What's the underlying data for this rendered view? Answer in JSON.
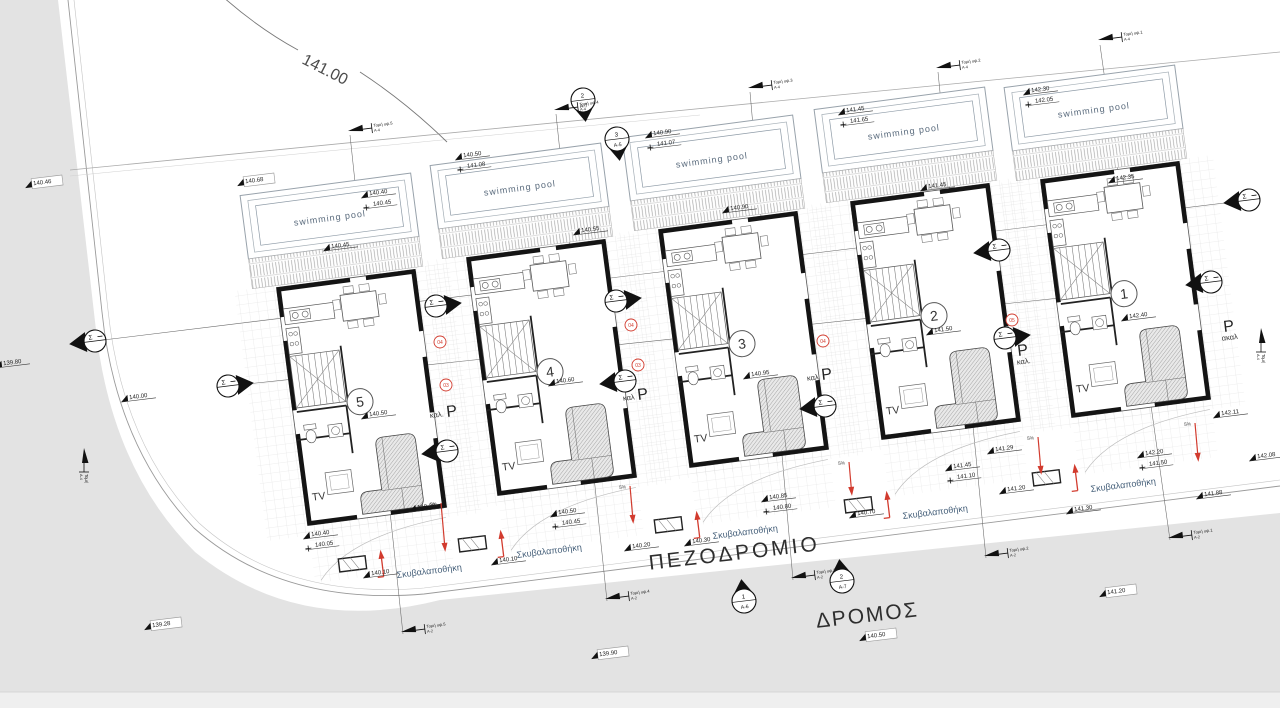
{
  "labels": {
    "contour": "141.00",
    "road": "ΔΡΟΜΟΣ",
    "sidewalk": "ΠΕΖΟΔΡΟΜΙΟ",
    "pool": "swimming pool",
    "tv": "TV",
    "garbage": "Σκυβαλαποθήκη",
    "parking_letter": "P",
    "sigma": "Σ",
    "percent": "5%"
  },
  "colors": {
    "road_gray": "#e3e3e3",
    "road_gray_light": "#efefef",
    "wall": "#141414",
    "line": "#3a3a3a",
    "light_line": "#c8c8c8",
    "red": "#d23b2e",
    "blue_text": "#46607a",
    "pool_text": "#5a6b7d"
  },
  "units": [
    {
      "number": "5",
      "x": 252,
      "y": 194,
      "rot": -7.5
    },
    {
      "number": "4",
      "x": 442,
      "y": 164,
      "rot": -7.5
    },
    {
      "number": "3",
      "x": 634,
      "y": 136,
      "rot": -7.5
    },
    {
      "number": "2",
      "x": 826,
      "y": 108,
      "rot": -7.5
    },
    {
      "number": "1",
      "x": 1016,
      "y": 86,
      "rot": -7.5
    }
  ],
  "spot_elevations": [
    {
      "v": "140.46",
      "x": 34,
      "y": 186,
      "box": true
    },
    {
      "v": "140.68",
      "x": 246,
      "y": 184,
      "box": true
    },
    {
      "v": "139.80",
      "x": 4,
      "y": 366
    },
    {
      "v": "140.00",
      "x": 130,
      "y": 400
    },
    {
      "v": "139.28",
      "x": 153,
      "y": 628,
      "box": true
    },
    {
      "v": "139.90",
      "x": 600,
      "y": 657,
      "box": true
    },
    {
      "v": "140.50",
      "x": 868,
      "y": 639,
      "box": true
    },
    {
      "v": "141.20",
      "x": 1108,
      "y": 595,
      "box": true
    },
    {
      "v": "140.10",
      "x": 372,
      "y": 576
    },
    {
      "v": "140.20",
      "x": 418,
      "y": 510
    },
    {
      "v": "140.10",
      "x": 500,
      "y": 563
    },
    {
      "v": "140.20",
      "x": 633,
      "y": 549
    },
    {
      "v": "140.30",
      "x": 693,
      "y": 544
    },
    {
      "v": "140.70",
      "x": 858,
      "y": 516
    },
    {
      "v": "141.20",
      "x": 1008,
      "y": 492
    },
    {
      "v": "141.29",
      "x": 996,
      "y": 452
    },
    {
      "v": "141.30",
      "x": 1075,
      "y": 512
    },
    {
      "v": "141.88",
      "x": 1205,
      "y": 497
    },
    {
      "v": "142.08",
      "x": 1258,
      "y": 459
    },
    {
      "v": "142.11",
      "x": 1222,
      "y": 416
    },
    {
      "v": "140.45",
      "x": 332,
      "y": 249
    },
    {
      "v": "140.55",
      "x": 582,
      "y": 233
    },
    {
      "v": "140.90",
      "x": 731,
      "y": 211
    },
    {
      "v": "141.45",
      "x": 929,
      "y": 189
    },
    {
      "v": "142.35",
      "x": 1117,
      "y": 181
    },
    {
      "v": "140.50",
      "x": 370,
      "y": 417
    },
    {
      "v": "140.60",
      "x": 557,
      "y": 384
    },
    {
      "v": "140.95",
      "x": 752,
      "y": 377
    },
    {
      "v": "141.50",
      "x": 935,
      "y": 333
    },
    {
      "v": "142.40",
      "x": 1130,
      "y": 319
    }
  ],
  "elevation_pairs": [
    {
      "a": "140.40",
      "b": "140.45",
      "x": 370,
      "y": 196
    },
    {
      "a": "140.50",
      "b": "141.08",
      "x": 464,
      "y": 158
    },
    {
      "a": "140.90",
      "b": "141.07",
      "x": 654,
      "y": 136
    },
    {
      "a": "141.45",
      "b": "141.65",
      "x": 847,
      "y": 113
    },
    {
      "a": "142.30",
      "b": "142.05",
      "x": 1032,
      "y": 93
    },
    {
      "a": "140.85",
      "b": "140.80",
      "x": 770,
      "y": 500
    },
    {
      "a": "142.20",
      "b": "141.50",
      "x": 1146,
      "y": 456
    },
    {
      "a": "140.40",
      "b": "140.05",
      "x": 312,
      "y": 537
    },
    {
      "a": "141.45",
      "b": "141.10",
      "x": 954,
      "y": 469
    },
    {
      "a": "140.50",
      "b": "140.45",
      "x": 559,
      "y": 515
    }
  ],
  "side_section_markers": [
    {
      "x": 95,
      "y": 341,
      "dir": "L"
    },
    {
      "x": 228,
      "y": 386,
      "dir": "R"
    },
    {
      "x": 436,
      "y": 306,
      "dir": "R"
    },
    {
      "x": 447,
      "y": 451,
      "dir": "L"
    },
    {
      "x": 616,
      "y": 301,
      "dir": "R"
    },
    {
      "x": 625,
      "y": 381,
      "dir": "L"
    },
    {
      "x": 825,
      "y": 406,
      "dir": "L"
    },
    {
      "x": 999,
      "y": 250,
      "dir": "L"
    },
    {
      "x": 1005,
      "y": 338,
      "dir": "R"
    },
    {
      "x": 1211,
      "y": 282,
      "dir": "L"
    },
    {
      "x": 1249,
      "y": 200,
      "dir": "L"
    }
  ],
  "top_section_markers": [
    {
      "x": 583,
      "y": 100,
      "num": "2",
      "sub": "Α-7"
    },
    {
      "x": 617,
      "y": 139,
      "num": "3",
      "sub": "Α-5"
    }
  ],
  "road_section_markers": [
    {
      "x": 744,
      "y": 601,
      "num": "1",
      "sub": "Α-6"
    },
    {
      "x": 842,
      "y": 581,
      "num": "2",
      "sub": "Α-7"
    }
  ],
  "red_reference_tags": [
    {
      "x": 440,
      "y": 342,
      "t": "04"
    },
    {
      "x": 446,
      "y": 385,
      "t": "03"
    },
    {
      "x": 631,
      "y": 325,
      "t": "04"
    },
    {
      "x": 638,
      "y": 365,
      "t": "03"
    },
    {
      "x": 823,
      "y": 341,
      "t": "04"
    },
    {
      "x": 1012,
      "y": 320,
      "t": "05"
    }
  ],
  "parking_labels": [
    {
      "x": 447,
      "y": 417,
      "sub": "καλ.",
      "pos": "left"
    },
    {
      "x": 638,
      "y": 400,
      "sub": "καλ",
      "pos": "left"
    },
    {
      "x": 822,
      "y": 380,
      "sub": "καλ",
      "pos": "left"
    },
    {
      "x": 1018,
      "y": 356,
      "sub": "καλ.",
      "pos": "below"
    },
    {
      "x": 1224,
      "y": 332,
      "sub": "ακαλ",
      "pos": "below"
    }
  ],
  "garbage_sheds": [
    {
      "x": 397,
      "y": 578
    },
    {
      "x": 517,
      "y": 558
    },
    {
      "x": 713,
      "y": 539
    },
    {
      "x": 903,
      "y": 519
    },
    {
      "x": 1091,
      "y": 492
    }
  ],
  "slope_arrows": [
    {
      "x": 441,
      "y1": 503,
      "y2": 548
    },
    {
      "x": 630,
      "y1": 486,
      "y2": 520
    },
    {
      "x": 849,
      "y1": 462,
      "y2": 492
    },
    {
      "x": 1038,
      "y1": 437,
      "y2": 471
    },
    {
      "x": 1195,
      "y1": 423,
      "y2": 458
    }
  ],
  "survey_arrows": [
    {
      "x": 1098,
      "y": 40,
      "m": "Τομή υψ.1",
      "s": "Α-4",
      "rot": -7
    },
    {
      "x": 936,
      "y": 68,
      "m": "Τομή υψ.2",
      "s": "Α-4",
      "rot": -7
    },
    {
      "x": 748,
      "y": 88,
      "m": "Τομή υψ.3",
      "s": "Α-4",
      "rot": -7
    },
    {
      "x": 554,
      "y": 110,
      "m": "Τομή υψ.4",
      "s": "Α-4",
      "rot": -7
    },
    {
      "x": 348,
      "y": 131,
      "m": "Τομή υψ.5",
      "s": "Α-4",
      "rot": -7
    },
    {
      "x": 1168,
      "y": 538,
      "m": "Τομή υψ.1",
      "s": "Α-2",
      "rot": -7
    },
    {
      "x": 984,
      "y": 556,
      "m": "Τομή υψ.2",
      "s": "Α-2",
      "rot": -7
    },
    {
      "x": 791,
      "y": 578,
      "m": "Τομή υψ.3",
      "s": "Α-2",
      "rot": -7
    },
    {
      "x": 605,
      "y": 599,
      "m": "Τομή υψ.4",
      "s": "Α-2",
      "rot": -7
    },
    {
      "x": 401,
      "y": 632,
      "m": "Τομή υψ.5",
      "s": "Α-2",
      "rot": -7
    },
    {
      "x": 84,
      "y": 448,
      "m": "Τομή",
      "s": "Α-4",
      "rot": 90
    },
    {
      "x": 1261,
      "y": 328,
      "m": "Τομή",
      "s": "Α-4",
      "rot": 90
    }
  ],
  "survey_lines": [
    [
      1100,
      45,
      1170,
      540
    ],
    [
      938,
      72,
      986,
      558
    ],
    [
      750,
      92,
      793,
      580
    ],
    [
      556,
      114,
      607,
      601
    ],
    [
      350,
      135,
      403,
      634
    ],
    [
      95,
      341,
      1249,
      200
    ],
    [
      228,
      386,
      1211,
      282
    ]
  ]
}
